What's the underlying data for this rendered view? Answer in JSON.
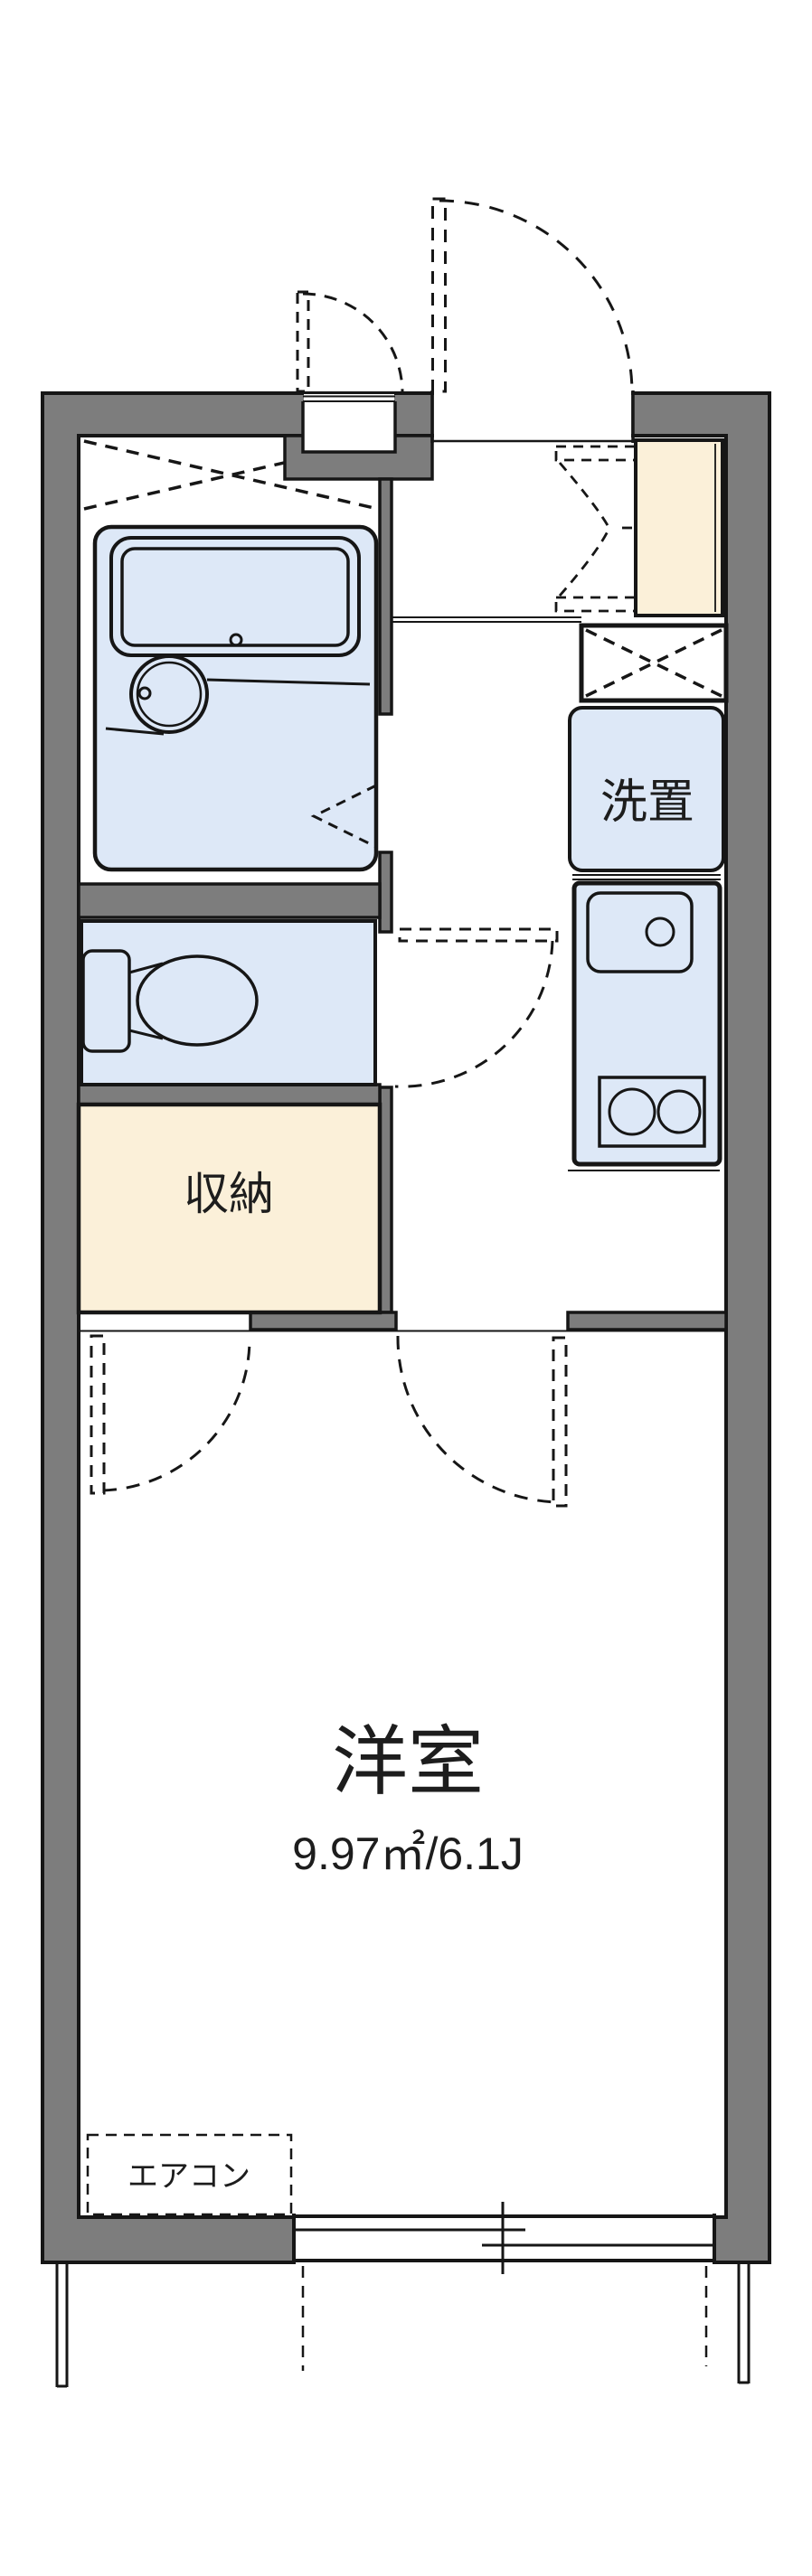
{
  "plan": {
    "type": "apartment-floor-plan",
    "labels": {
      "main_room": "洋室",
      "main_room_size": "9.97㎡/6.1J",
      "closet": "収納",
      "washer_space": "洗置",
      "aircon": "エアコン"
    },
    "rooms": [
      {
        "name": "western-room",
        "label": "洋室",
        "size": "9.97㎡/6.1J"
      },
      {
        "name": "closet",
        "label": "収納"
      },
      {
        "name": "washer-space",
        "label": "洗置"
      },
      {
        "name": "aircon-spot",
        "label": "エアコン"
      },
      {
        "name": "unit-bath",
        "label": ""
      },
      {
        "name": "toilet",
        "label": ""
      },
      {
        "name": "kitchen",
        "label": ""
      },
      {
        "name": "entrance",
        "label": ""
      }
    ],
    "colors": {
      "wall_fill": "#7d7d7d",
      "outline": "#161616",
      "fixture_fill": "#dde8f7",
      "storage_fill": "#fbf0d9",
      "background": "#ffffff"
    }
  }
}
